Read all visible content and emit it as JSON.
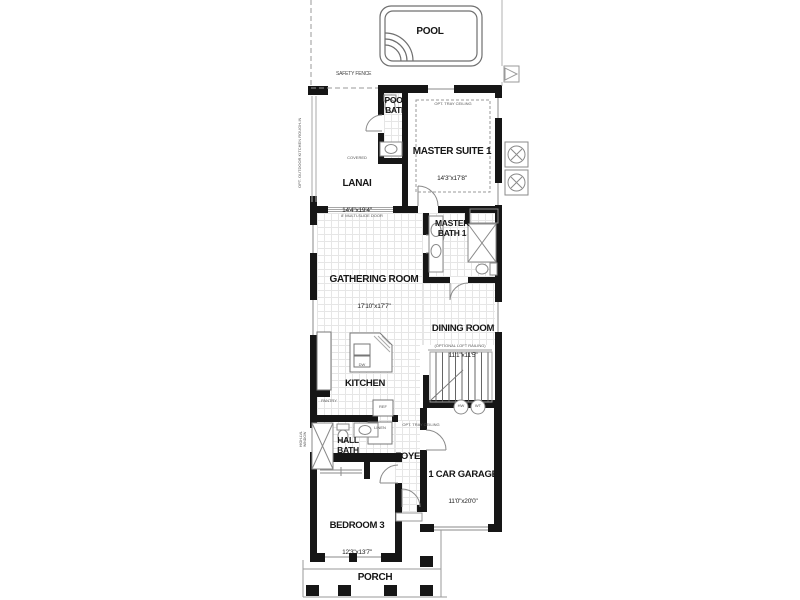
{
  "rooms": {
    "pool": {
      "name": "POOL"
    },
    "pool_bath": {
      "name": "POOL BATH"
    },
    "master_suite": {
      "name": "MASTER SUITE 1",
      "dims": "14'3\"x17'8\""
    },
    "lanai": {
      "tag": "COVERED",
      "name": "LANAI",
      "dims": "14'4\"x19'4\""
    },
    "master_bath": {
      "name": "MASTER BATH 1"
    },
    "gathering": {
      "name": "GATHERING ROOM",
      "dims": "17'10\"x17'7\""
    },
    "dining": {
      "name": "DINING ROOM",
      "dims": "11'1\"x11'5\""
    },
    "kitchen": {
      "name": "KITCHEN"
    },
    "hall_bath": {
      "name": "HALL BATH"
    },
    "foyer": {
      "name": "FOYER"
    },
    "garage": {
      "name": "1 CAR GARAGE",
      "dims": "11'0\"x20'0\""
    },
    "bedroom3": {
      "name": "BEDROOM 3",
      "dims": "12'3\"x13'7\""
    },
    "porch": {
      "name": "PORCH"
    }
  },
  "annotations": {
    "safety_fence": "SAFETY FENCE",
    "tray_master": "OPT. TRAY CEILING",
    "tray_foyer": "OPT. TRAY CEILING",
    "multi_slide": "8' MULTI-SLIDE DOOR",
    "outdoor_kitchen": "OPT. OUTDOOR KITCHEN ROUGH-IN",
    "loft_railing": "(OPTIONAL LOFT RAILING)",
    "pantry": "PANTRY",
    "ref": "REF",
    "linen": "LINEN",
    "dw": "DW",
    "hw": "HW",
    "wt": "WT",
    "hi_window": "HIGH-LVL WINDOW"
  },
  "colors": {
    "wall": "#161616",
    "line": "#8a8a8a",
    "grid": "#e6e6e6"
  }
}
